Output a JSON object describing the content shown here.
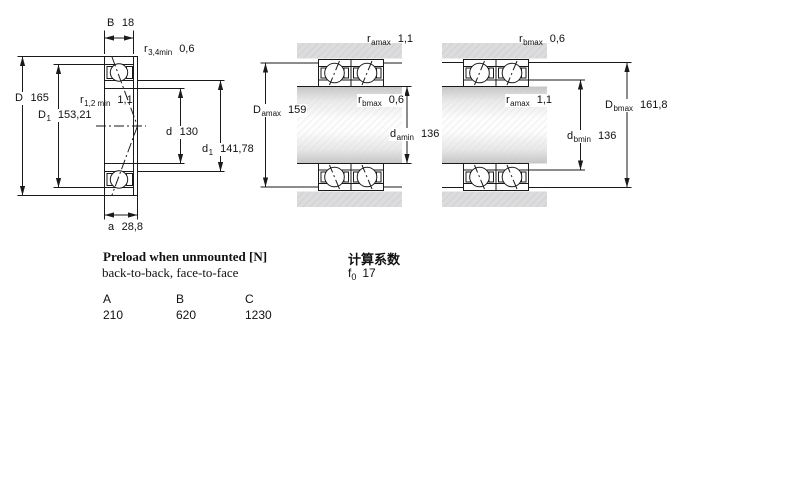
{
  "figure": {
    "left": {
      "labels": {
        "B": {
          "base": "B",
          "value": "18"
        },
        "r34": {
          "base": "r",
          "sub": "3,4min",
          "value": "0,6"
        },
        "D": {
          "base": "D",
          "value": "165"
        },
        "D1": {
          "base": "D",
          "sub": "1",
          "value": "153,21"
        },
        "r12": {
          "base": "r",
          "sub": "1,2 min",
          "value": "1,1"
        },
        "d": {
          "base": "d",
          "value": "130"
        },
        "d1": {
          "base": "d",
          "sub": "1",
          "value": "141,78"
        },
        "a": {
          "base": "a",
          "value": "28,8"
        }
      }
    },
    "middle": {
      "labels": {
        "ramax": {
          "base": "r",
          "sub": "amax",
          "value": "1,1"
        },
        "Damax": {
          "base": "D",
          "sub": "amax",
          "value": "159"
        },
        "rbmax": {
          "base": "r",
          "sub": "bmax",
          "value": "0,6"
        },
        "damin": {
          "base": "d",
          "sub": "amin",
          "value": "136"
        }
      }
    },
    "right": {
      "labels": {
        "rbmax": {
          "base": "r",
          "sub": "bmax",
          "value": "0,6"
        },
        "ramax": {
          "base": "r",
          "sub": "amax",
          "value": "1,1"
        },
        "Dbmax": {
          "base": "D",
          "sub": "bmax",
          "value": "161,8"
        },
        "dbmin": {
          "base": "d",
          "sub": "bmin",
          "value": "136"
        }
      }
    }
  },
  "preload": {
    "title": "Preload when unmounted [N]",
    "subtitle": "back-to-back, face-to-face",
    "columns": [
      "A",
      "B",
      "C"
    ],
    "values": [
      "210",
      "620",
      "1230"
    ]
  },
  "calculation": {
    "title": "计算系数",
    "factor": {
      "base": "f",
      "sub": "0",
      "value": "17"
    }
  },
  "colors": {
    "line": "#1a1a1a",
    "ring_fill": "#cdd7f2",
    "ring_hatch": "#9db0dd",
    "steel_gray": "#dcdcdc"
  }
}
